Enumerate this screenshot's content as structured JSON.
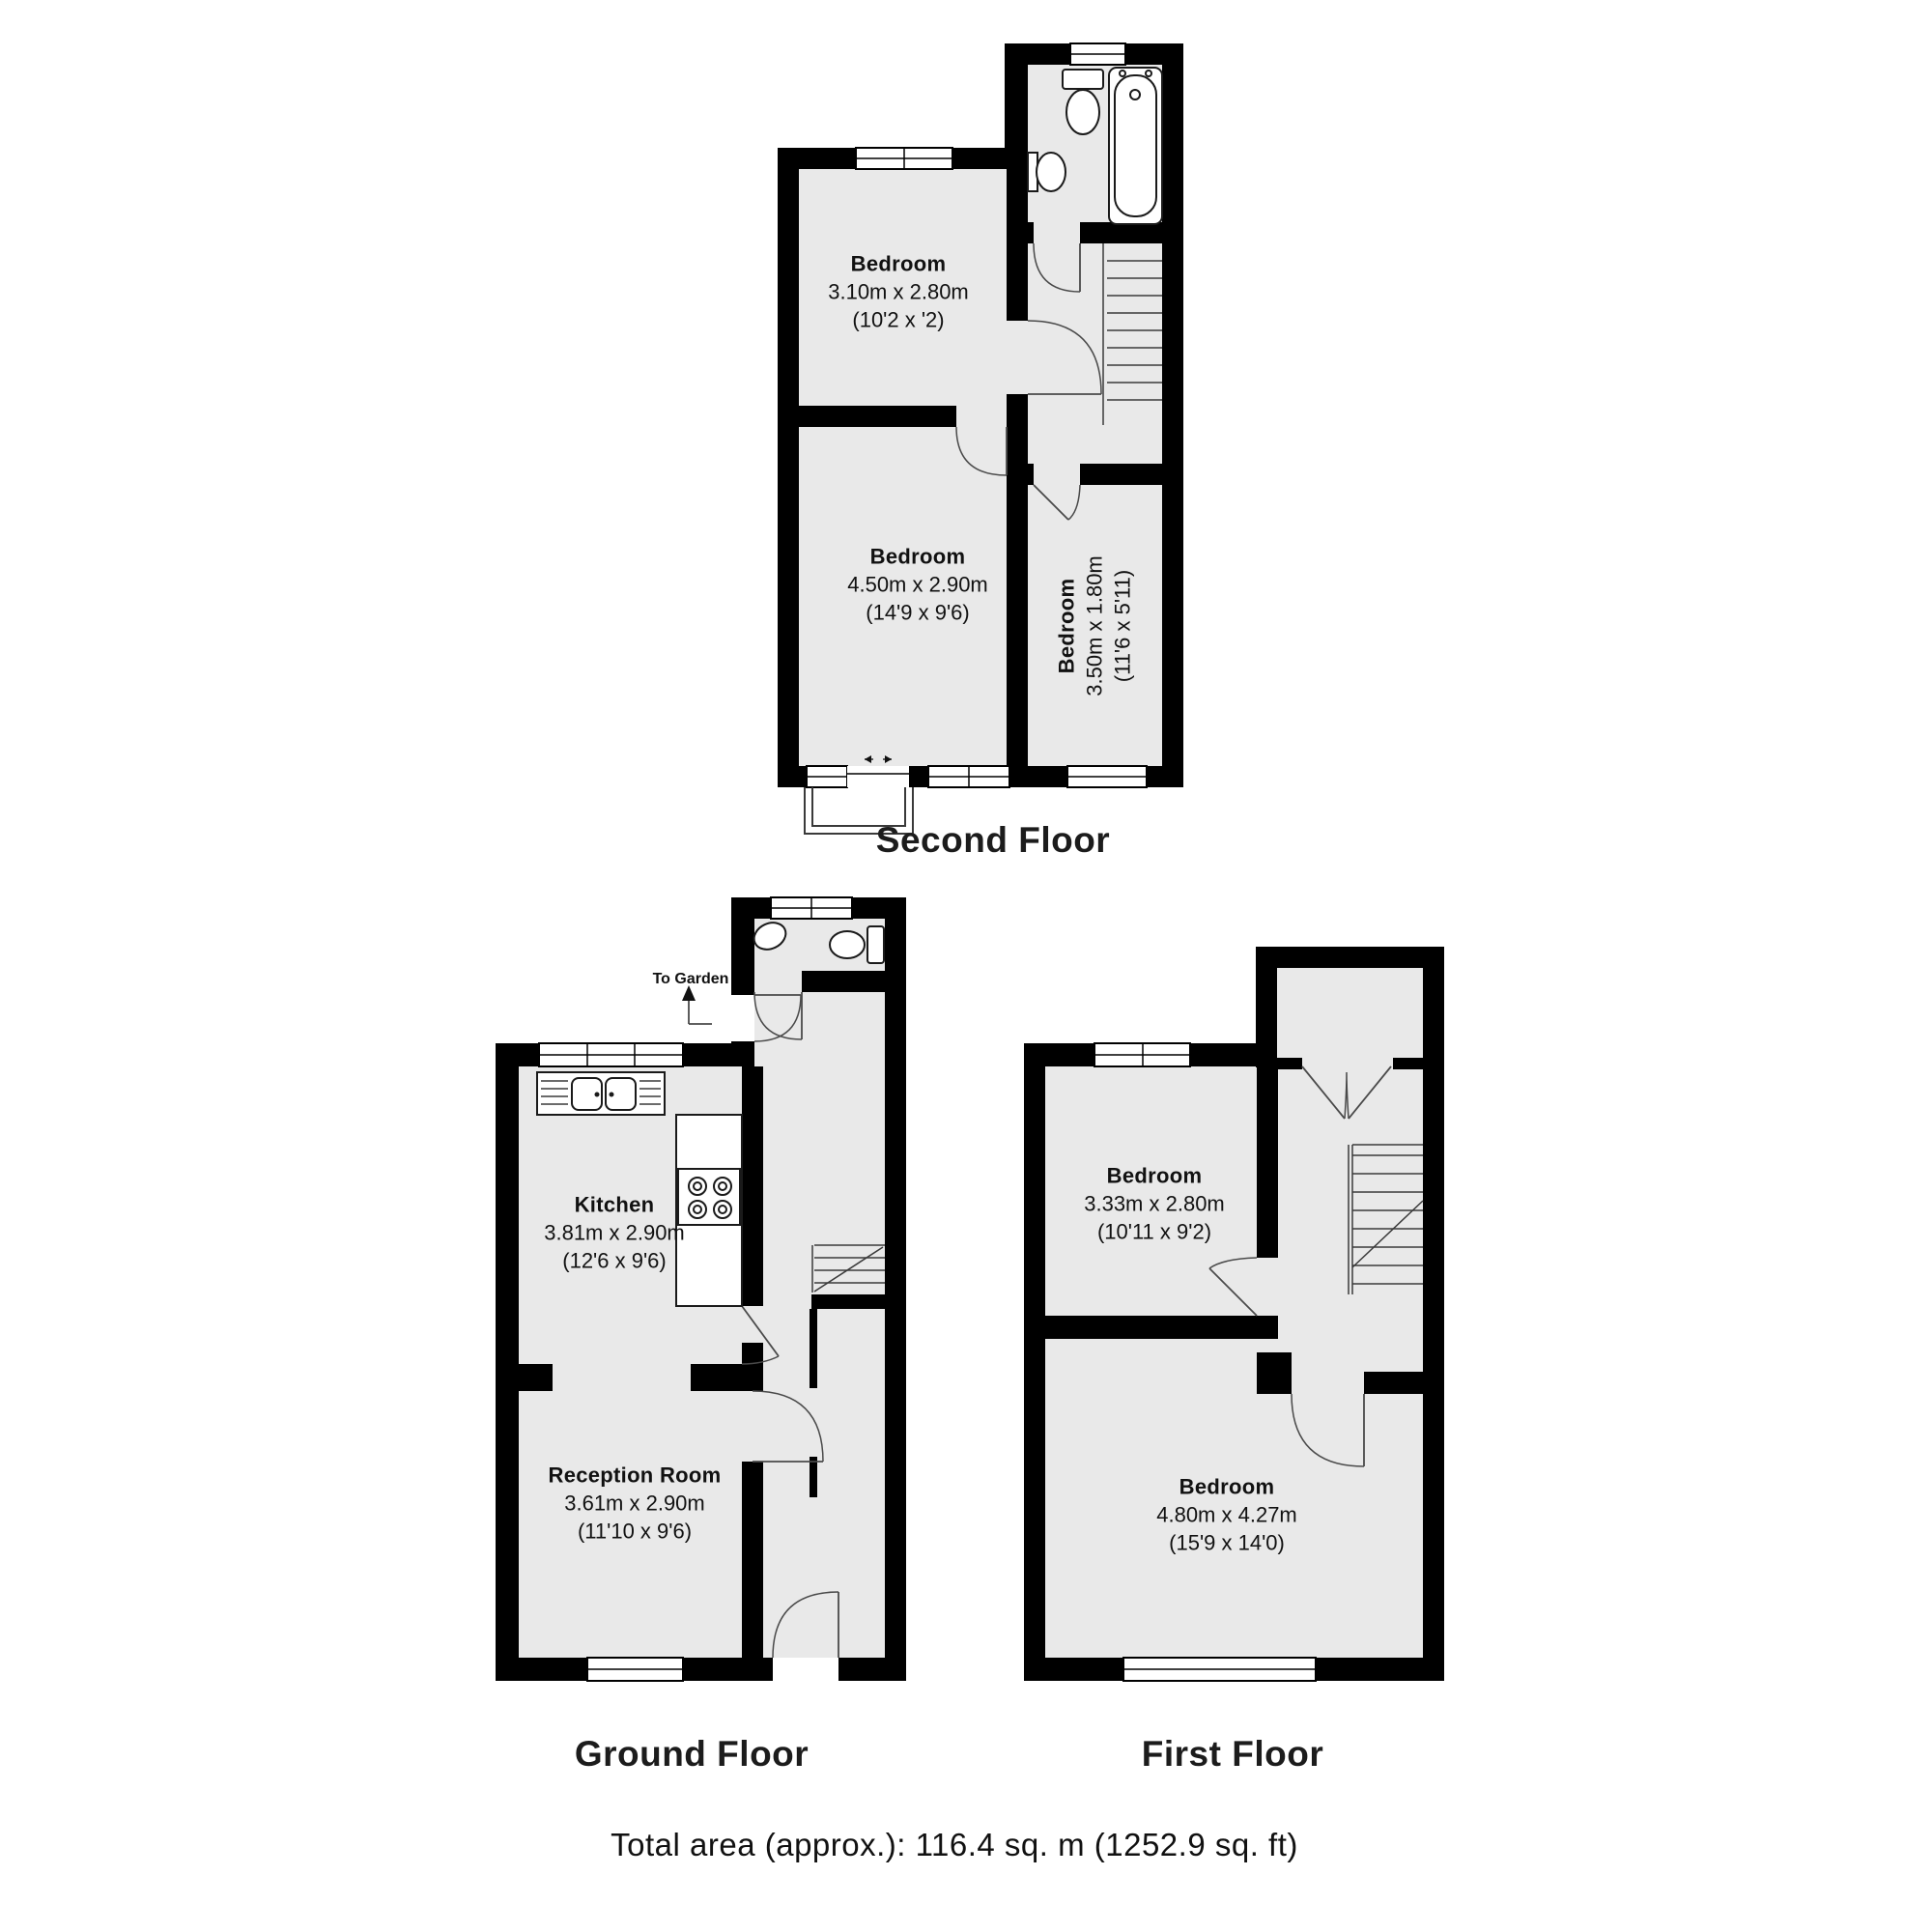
{
  "floors": {
    "second": {
      "label": "Second Floor",
      "rooms": {
        "bedroom_small": {
          "name": "Bedroom",
          "dims_m": "3.10m x 2.80m",
          "dims_ft": "(10'2 x '2)"
        },
        "bedroom_large": {
          "name": "Bedroom",
          "dims_m": "4.50m x 2.90m",
          "dims_ft": "(14'9 x 9'6)"
        },
        "bedroom_narrow": {
          "name": "Bedroom",
          "dims_m": "3.50m x 1.80m",
          "dims_ft": "(11'6 x 5'11)"
        }
      }
    },
    "ground": {
      "label": "Ground Floor",
      "to_garden": "To Garden",
      "rooms": {
        "kitchen": {
          "name": "Kitchen",
          "dims_m": "3.81m x 2.90m",
          "dims_ft": "(12'6 x 9'6)"
        },
        "reception": {
          "name": "Reception Room",
          "dims_m": "3.61m x 2.90m",
          "dims_ft": "(11'10 x 9'6)"
        }
      }
    },
    "first": {
      "label": "First Floor",
      "rooms": {
        "bedroom_rear": {
          "name": "Bedroom",
          "dims_m": "3.33m x 2.80m",
          "dims_ft": "(10'11 x 9'2)"
        },
        "bedroom_front": {
          "name": "Bedroom",
          "dims_m": "4.80m x 4.27m",
          "dims_ft": "(15'9 x 14'0)"
        }
      }
    }
  },
  "footer": {
    "total_area": "Total area (approx.): 116.4 sq. m (1252.9 sq. ft)"
  }
}
